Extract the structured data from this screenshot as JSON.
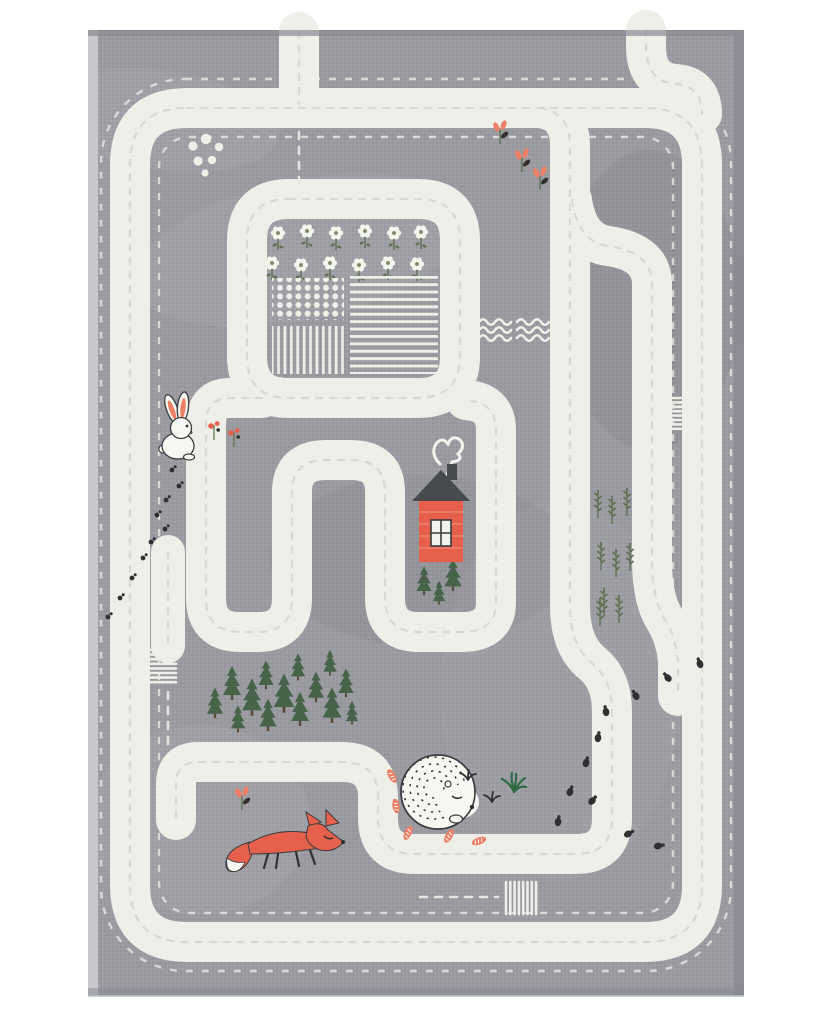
{
  "scene": {
    "type": "product photo",
    "subject": "children's road-maze play rug, top-down view",
    "background": "white"
  },
  "palette": {
    "page_bg": "#ffffff",
    "rug_gray": "#9a9aa1",
    "rug_gray_dark": "#87878f",
    "fringe_light": "#c7c7cc",
    "edge_dark": "#8b8b93",
    "road_white": "#edefe8",
    "stitch_gray": "#d3d6cf",
    "stitch_light": "#e7e9e2",
    "accent_coral": "#e6604c",
    "leaf_coral": "#ef7f66",
    "roof_dark": "#474b50",
    "pine_green": "#47634a",
    "wheat_green": "#5d7050",
    "grass_green": "#2e6a45",
    "ink_dark": "#2e3032",
    "trunk_brown": "#5a4a3c"
  },
  "inventory": {
    "animals": [
      {
        "name": "rabbit",
        "description": "white bunny with coral inner ears, sitting"
      },
      {
        "name": "fox",
        "description": "coral-orange fox with white tail tip, walking"
      },
      {
        "name": "hedgehog",
        "description": "white hedgehog with dark spine dashes, curled up sleeping"
      }
    ],
    "buildings": [
      {
        "name": "cottage",
        "description": "coral-red house, dark roof, white window, heart-shaped chimney smoke"
      }
    ],
    "flora": {
      "daisy_rows": 2,
      "daisies_per_row": 6,
      "forest_pines": 14,
      "pines_by_house": 3,
      "wheat_stalks": 9,
      "red_flower_sprigs_top_right": 3,
      "berry_sprigs_by_rabbit": 2,
      "red_sprig_by_fox": 1,
      "grass_tufts": 3,
      "carrot_leaves_by_hedgehog": 7
    },
    "fields": [
      "dot crop field",
      "horizontal stripe field",
      "vertical stripe field"
    ],
    "road_features": {
      "crosswalks": 4,
      "dead_end_stubs": 2,
      "dashed_minor_roads": 3,
      "border_stitch_lines": 2
    },
    "trails": {
      "paw_prints": 10,
      "beetles": 11
    },
    "water_wave_groups": 2,
    "pebbles": 6
  }
}
